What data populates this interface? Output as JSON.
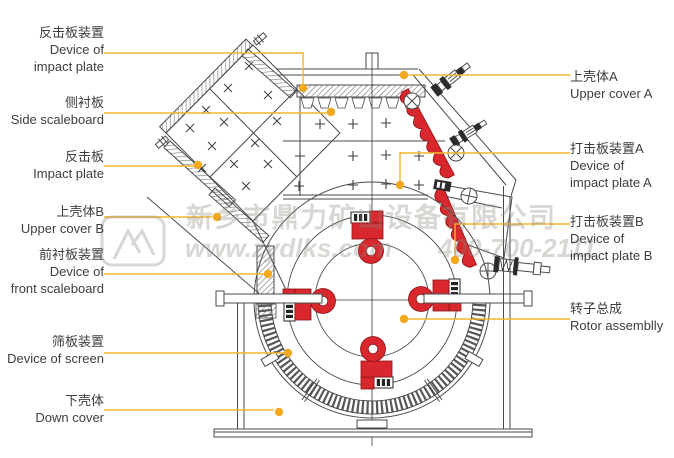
{
  "title": "Impact crusher structure diagram",
  "watermark": {
    "company": "新乡市鼎力矿山设备有限公司",
    "website": "www.zydlks.com",
    "phone": "400-700-2111",
    "logo": "mountain-logo"
  },
  "labels": {
    "left": [
      {
        "zh": "反击板装置",
        "en": "Device of\nimpact plate"
      },
      {
        "zh": "侧衬板",
        "en": "Side scaleboard"
      },
      {
        "zh": "反击板",
        "en": "Impact plate"
      },
      {
        "zh": "上壳体B",
        "en": "Upper cover B"
      },
      {
        "zh": "前衬板装置",
        "en": "Device of\nfront scaleboard"
      },
      {
        "zh": "筛板装置",
        "en": "Device of screen"
      },
      {
        "zh": "下壳体",
        "en": "Down cover"
      }
    ],
    "right": [
      {
        "zh": "上壳体A",
        "en": "Upper cover A"
      },
      {
        "zh": "打击板装置A",
        "en": "Device of\nimpact plate A"
      },
      {
        "zh": "打击板装置B",
        "en": "Device of\nimpact plate B"
      },
      {
        "zh": "转子总成",
        "en": "Rotor assemblly"
      }
    ]
  },
  "colors": {
    "leader_line": "#f5b52a",
    "leader_dot": "#f2a81f",
    "part_red": "#d8282d",
    "drawing_line": "#4a4a4a"
  }
}
